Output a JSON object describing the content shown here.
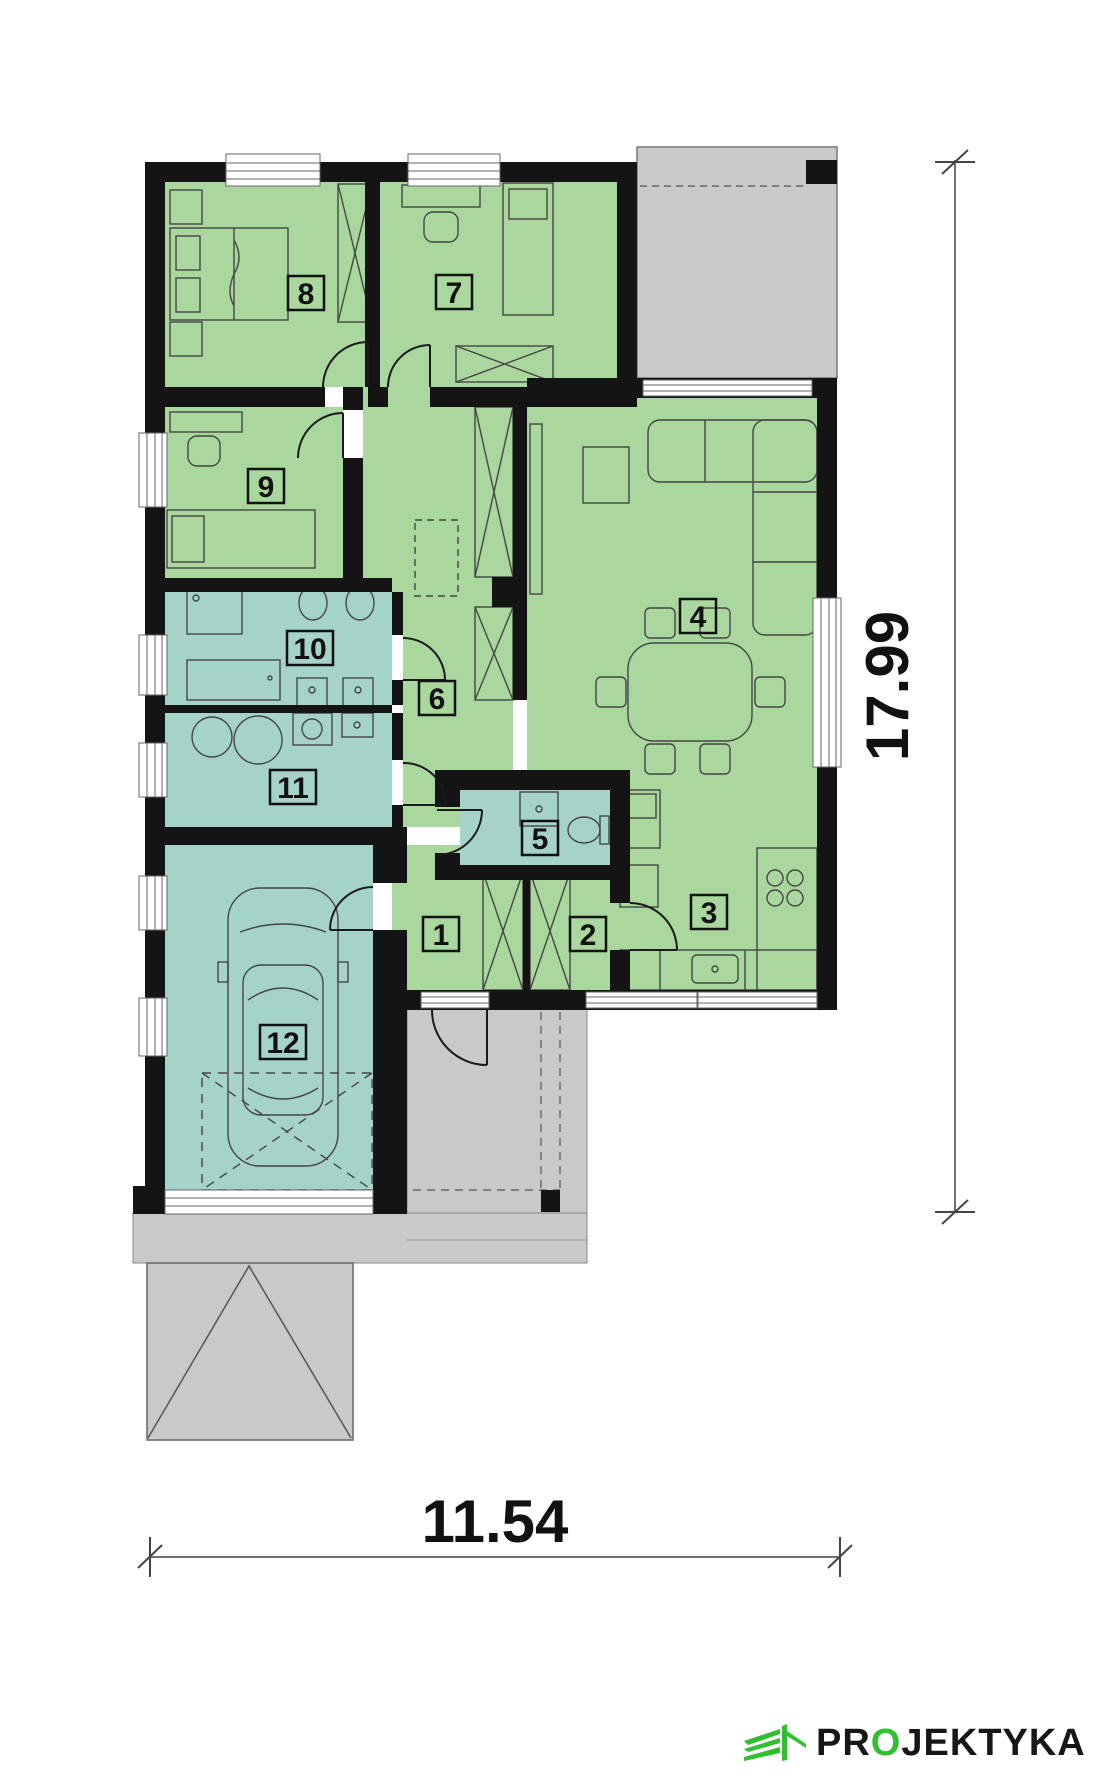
{
  "plan": {
    "rooms": [
      {
        "number": "1"
      },
      {
        "number": "2"
      },
      {
        "number": "3"
      },
      {
        "number": "4"
      },
      {
        "number": "5"
      },
      {
        "number": "6"
      },
      {
        "number": "7"
      },
      {
        "number": "8"
      },
      {
        "number": "9"
      },
      {
        "number": "10"
      },
      {
        "number": "11"
      },
      {
        "number": "12"
      }
    ]
  },
  "dimensions": {
    "width_label": "11.54",
    "height_label": "17.99"
  },
  "logo": {
    "part1": "PR",
    "accent": "O",
    "part2": "JEKTYKA"
  },
  "colors": {
    "room_green": "#a9d79e",
    "room_teal": "#a6d3c9",
    "outdoor_gray": "#c9c9c9",
    "wall_black": "#141414",
    "logo_green": "#2fbf2f"
  }
}
